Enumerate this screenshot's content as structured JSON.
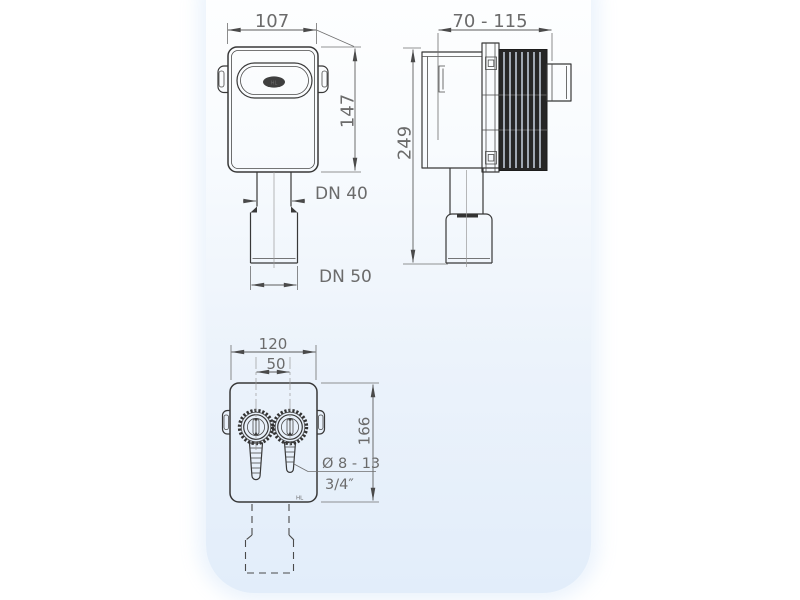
{
  "meta": {
    "background_color": "#ffffff",
    "panel_top_color": "#ffffff",
    "panel_bottom_color": "#e2edfa",
    "line_color": "#383838",
    "dimension_text_color": "#6b6b6b"
  },
  "views": {
    "front": {
      "label": "front-view",
      "dims": {
        "width": "107",
        "height": "147",
        "outlet_upper": "DN 40",
        "outlet_lower": "DN 50"
      },
      "logo": "HL"
    },
    "side": {
      "label": "side-view",
      "dims": {
        "depth": "70 - 115",
        "height": "249"
      }
    },
    "bottom": {
      "label": "bottom-view",
      "dims": {
        "width": "120",
        "port_spacing": "50",
        "height": "166",
        "hose_diameter": "Ø 8 - 13",
        "thread": "3/4″"
      },
      "logo": "HL"
    }
  }
}
